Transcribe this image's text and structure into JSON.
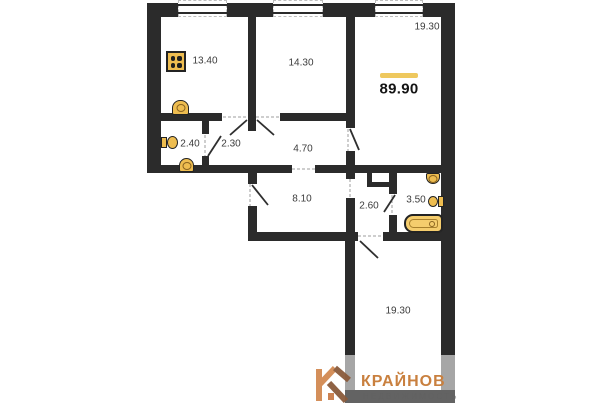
{
  "plan": {
    "total_area_label": "89.90",
    "rooms": [
      {
        "name": "kitchen",
        "area": "13.40"
      },
      {
        "name": "bedroom-1",
        "area": "14.30"
      },
      {
        "name": "living-room",
        "area": "19.30"
      },
      {
        "name": "hall",
        "area": "2.40"
      },
      {
        "name": "storage",
        "area": "2.30"
      },
      {
        "name": "hallway",
        "area": "4.70"
      },
      {
        "name": "corridor",
        "area": "8.10"
      },
      {
        "name": "wc-hall",
        "area": "2.60"
      },
      {
        "name": "bathroom",
        "area": "3.50"
      },
      {
        "name": "bedroom-2",
        "area": "19.30"
      }
    ],
    "accent_colors": {
      "wall": "#2b2b2b",
      "fixture_gold": "#eebd50",
      "area_marker_yellow": "#eec85e"
    }
  },
  "logo": {
    "brand": "КРАЙНОВ",
    "tagline": "НЕДВИЖИМОСТЬ",
    "brand_color": "#c9803f"
  }
}
